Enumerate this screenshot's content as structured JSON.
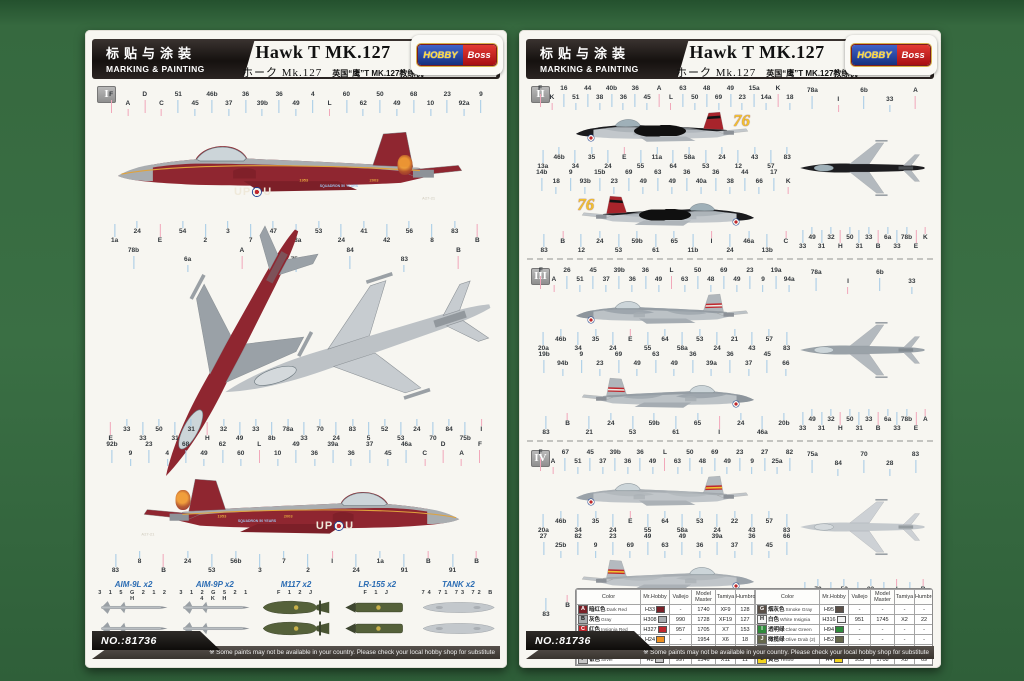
{
  "doc": {
    "kit_no": "NO.:81736",
    "footer_note": "※ Some paints may not be available in your country. Please check your local hobby shop for substitute"
  },
  "header": {
    "cn_title": "标贴与涂装",
    "en_title": "MARKING & PAINTING",
    "title": "Hawk T MK.127",
    "subtitle_jp": "ホーク Mk.127",
    "subtitle_cn": "英国“鹰”T MK.127教练机",
    "logo_left": "HOBBY",
    "logo_right": "Boss"
  },
  "palette": {
    "background_green": "#36693f",
    "page": "#f7f6f1",
    "maroon": "#8f2630",
    "insignia_red": "#c0272d",
    "tail_yellow": "#f2c12e",
    "label_blue": "#2b6cb3",
    "leader_blue": "#a3c9e6",
    "leader_pink": "#f1a7ba"
  },
  "left_page": {
    "scheme_label": "I",
    "marking": {
      "code_left": "UP",
      "code_right": "U",
      "year_1": "1953",
      "year_2": "2003",
      "squadron_text": "SQUADRON 50 YEARS",
      "serial": "A27-21"
    },
    "v1_top": [
      "F",
      "A",
      "D",
      "C",
      "51",
      "45",
      "46b",
      "37",
      "36",
      "39b",
      "36",
      "49",
      "4",
      "L",
      "60",
      "62",
      "50",
      "49",
      "68",
      "10",
      "23",
      "92a",
      "9"
    ],
    "v1_bot": [
      "1a",
      "24",
      "E",
      "54",
      "2",
      "3",
      "7",
      "47",
      "58a",
      "53",
      "24",
      "41",
      "42",
      "56",
      "8",
      "83",
      "B"
    ],
    "v2_top": [
      "78b",
      "6a",
      "A",
      "75a",
      "84",
      "83",
      "B"
    ],
    "v2_bot": [
      "E",
      "33",
      "33",
      "50",
      "31",
      "31",
      "H",
      "32",
      "49",
      "33",
      "8b",
      "78a",
      "33",
      "70",
      "24",
      "83",
      "5",
      "52",
      "53",
      "24",
      "70",
      "84",
      "75b",
      "I"
    ],
    "v3_top": [
      "92b",
      "9",
      "23",
      "4",
      "68",
      "49",
      "62",
      "60",
      "L",
      "10",
      "49",
      "36",
      "39a",
      "36",
      "37",
      "45",
      "46a",
      "C",
      "D",
      "A",
      "F"
    ],
    "v3_bot": [
      "83",
      "8",
      "B",
      "24",
      "53",
      "56b",
      "3",
      "7",
      "2",
      "I",
      "24",
      "1a",
      "91",
      "B",
      "91",
      "B"
    ],
    "weapons": [
      {
        "label": "AIM-9L x2",
        "nums": "3 1 5 G 2 1 2 H",
        "type": "w-missile"
      },
      {
        "label": "AIM-9P x2",
        "nums": "3 1 2 G 5 2 1 4 K H",
        "type": "w-missile"
      },
      {
        "label": "M117 x2",
        "nums": "F 1 2 J",
        "type": "w-bomb"
      },
      {
        "label": "LR-155 x2",
        "nums": "F 1 J",
        "type": "w-rocket"
      },
      {
        "label": "TANK x2",
        "nums": "74 71 73 72 B",
        "type": "w-tank"
      }
    ]
  },
  "right_page": {
    "schemes": [
      {
        "label": "II",
        "tail_number": "76",
        "s1_top": [
          "F",
          "K",
          "16",
          "51",
          "44",
          "38",
          "40b",
          "36",
          "36",
          "45",
          "A",
          "L",
          "63",
          "50",
          "48",
          "69",
          "49",
          "23",
          "15a",
          "14a",
          "K",
          "18"
        ],
        "s1_bot": [
          "13a",
          "46b",
          "34",
          "35",
          "24",
          "E",
          "55",
          "11a",
          "64",
          "58a",
          "53",
          "24",
          "12",
          "43",
          "57",
          "83"
        ],
        "s2_top": [
          "14b",
          "18",
          "9",
          "93b",
          "15b",
          "23",
          "69",
          "49",
          "63",
          "49",
          "36",
          "40a",
          "36",
          "38",
          "44",
          "66",
          "17",
          "K"
        ],
        "s2_bot": [
          "83",
          "B",
          "12",
          "24",
          "53",
          "59b",
          "61",
          "65",
          "11b",
          "I",
          "24",
          "46a",
          "13b",
          "C"
        ],
        "p_top": [
          "78a",
          "I",
          "6b",
          "33",
          "A"
        ],
        "p_bot": [
          "33",
          "49",
          "31",
          "32",
          "H",
          "50",
          "31",
          "33",
          "B",
          "6a",
          "33",
          "78b",
          "E",
          "K"
        ]
      },
      {
        "label": "III",
        "tail_number": "",
        "s1_top": [
          "F",
          "A",
          "26",
          "51",
          "45",
          "37",
          "39b",
          "36",
          "36",
          "49",
          "L",
          "63",
          "50",
          "48",
          "69",
          "49",
          "23",
          "9",
          "19a",
          "94a"
        ],
        "s1_bot": [
          "20a",
          "46b",
          "34",
          "35",
          "24",
          "E",
          "55",
          "64",
          "58a",
          "53",
          "24",
          "21",
          "43",
          "57",
          "83"
        ],
        "s2_top": [
          "19b",
          "94b",
          "9",
          "23",
          "69",
          "49",
          "63",
          "49",
          "36",
          "39a",
          "36",
          "37",
          "45",
          "66"
        ],
        "s2_bot": [
          "83",
          "B",
          "21",
          "24",
          "53",
          "59b",
          "61",
          "65",
          "I",
          "24",
          "46a",
          "20b"
        ],
        "p_top": [
          "78a",
          "I",
          "6b",
          "33"
        ],
        "p_bot": [
          "33",
          "49",
          "31",
          "32",
          "H",
          "50",
          "31",
          "33",
          "B",
          "6a",
          "33",
          "78b",
          "E",
          "A"
        ]
      },
      {
        "label": "IV",
        "tail_number": "",
        "s1_top": [
          "F",
          "A",
          "67",
          "51",
          "45",
          "37",
          "39b",
          "36",
          "36",
          "49",
          "L",
          "63",
          "50",
          "48",
          "69",
          "49",
          "23",
          "9",
          "27",
          "25a",
          "82"
        ],
        "s1_bot": [
          "20a",
          "46b",
          "34",
          "35",
          "24",
          "E",
          "55",
          "64",
          "58a",
          "53",
          "24",
          "22",
          "43",
          "57",
          "83"
        ],
        "s2_top": [
          "27",
          "25b",
          "82",
          "9",
          "23",
          "69",
          "49",
          "63",
          "49",
          "36",
          "39a",
          "37",
          "36",
          "45",
          "66"
        ],
        "s2_bot": [
          "83",
          "B",
          "22",
          "24",
          "53",
          "59b",
          "61",
          "65",
          "I",
          "24",
          "46a",
          "20b"
        ],
        "p_top": [
          "75a",
          "84",
          "70",
          "28",
          "83"
        ],
        "p_bot": [
          "24",
          "70",
          "53",
          "52",
          "24",
          "83",
          "84",
          "I",
          "75b",
          "B"
        ]
      }
    ],
    "table": {
      "columns": [
        "Color",
        "Mr.Hobby",
        "Vallejo",
        "Model Master",
        "Tamiya",
        "Humbrol"
      ],
      "left_rows": [
        {
          "letter": "A",
          "swatch": "#7a2027",
          "cn": "暗红色",
          "en": "Dark Red",
          "mh": "H33",
          "va": "-",
          "mm": "1740",
          "ta": "XF9",
          "hu": "128"
        },
        {
          "letter": "B",
          "swatch": "#a9adb0",
          "cn": "灰色",
          "en": "Gray",
          "mh": "H308",
          "va": "990",
          "mm": "1728",
          "ta": "XF19",
          "hu": "127"
        },
        {
          "letter": "C",
          "swatch": "#c0272d",
          "cn": "红色",
          "en": "Insignia Red",
          "mh": "H327",
          "va": "957",
          "mm": "1705",
          "ta": "X7",
          "hu": "153"
        },
        {
          "letter": "D",
          "swatch": "#ef9021",
          "cn": "橙黄色",
          "en": "Orange Yellow",
          "mh": "H24",
          "va": "-",
          "mm": "1954",
          "ta": "X6",
          "hu": "18"
        },
        {
          "letter": "E",
          "swatch": "#d04048",
          "cn": "透明红",
          "en": "Clear Red",
          "mh": "H90",
          "va": "934",
          "mm": "-",
          "ta": "X27",
          "hu": "-"
        },
        {
          "letter": "F",
          "swatch": "#c7c7c7",
          "cn": "银色",
          "en": "Silver",
          "mh": "H8",
          "va": "997",
          "mm": "1546",
          "ta": "X11",
          "hu": "11"
        }
      ],
      "right_rows": [
        {
          "letter": "G",
          "swatch": "#5a4f47",
          "cn": "烟灰色",
          "en": "Smoke Gray",
          "mh": "H95",
          "va": "-",
          "mm": "-",
          "ta": "-",
          "hu": "-"
        },
        {
          "letter": "H",
          "swatch": "#f4f4f4",
          "cn": "白色",
          "en": "White Insignia",
          "mh": "H316",
          "va": "951",
          "mm": "1745",
          "ta": "X2",
          "hu": "22"
        },
        {
          "letter": "I",
          "swatch": "#2f8b3b",
          "cn": "透明绿",
          "en": "Clear Green",
          "mh": "H94",
          "va": "-",
          "mm": "-",
          "ta": "-",
          "hu": "-"
        },
        {
          "letter": "J",
          "swatch": "#66684c",
          "cn": "橄榄绿",
          "en": "Olive Drab (2)",
          "mh": "H52",
          "va": "-",
          "mm": "-",
          "ta": "-",
          "hu": "-"
        },
        {
          "letter": "K",
          "swatch": "#161616",
          "cn": "黑色",
          "en": "Black",
          "mh": "H2",
          "va": "950",
          "mm": "1747",
          "ta": "X1",
          "hu": "21"
        },
        {
          "letter": "L",
          "swatch": "#f2d41f",
          "cn": "黄色",
          "en": "Yellow",
          "mh": "H4",
          "va": "953",
          "mm": "1708",
          "ta": "X8",
          "hu": "69"
        }
      ]
    }
  }
}
